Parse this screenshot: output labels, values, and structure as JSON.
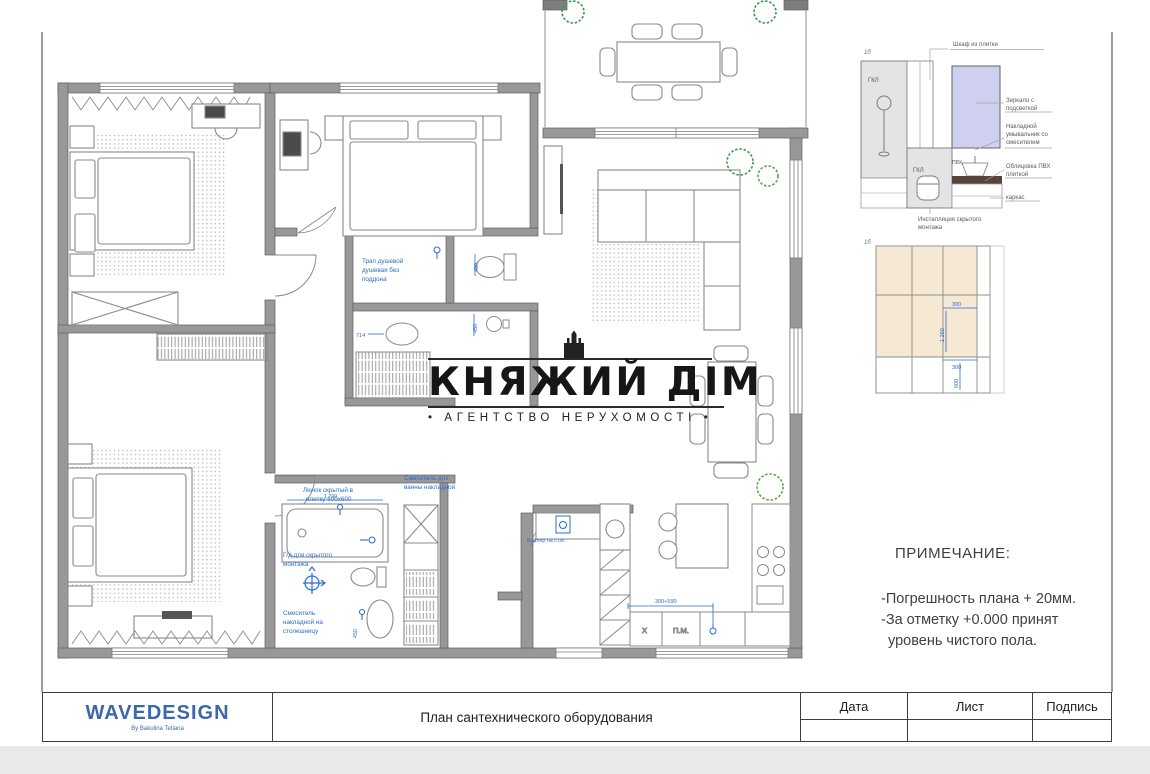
{
  "watermark": {
    "title": "КНЯЖИЙ ДІМ",
    "subtitle": "• АГЕНТСТВО НЕРУХОМОСТІ •"
  },
  "notes": {
    "heading": "ПРИМЕЧАНИЕ:",
    "lines": [
      "-Погрешность плана + 20мм.",
      "-За отметку +0.000 принят",
      "уровень чистого пола."
    ]
  },
  "title_block": {
    "brand": "WAVEDESIGN",
    "brand_subtitle": "By Bakulina Tetiana",
    "drawing_title": "План сантехнического оборудования",
    "columns": [
      "Дата",
      "Лист",
      "Подпись"
    ]
  },
  "plan": {
    "shower_note": [
      "Трап душевой",
      "душевая без",
      "поддона"
    ],
    "hatch_note": [
      "Лючок скрытый в",
      "плитку 600х600"
    ],
    "bath_mixer_note": [
      "Смеситель для",
      "ванны накладной"
    ],
    "concealed_note": [
      "Г/д для скрытого",
      "монтажа"
    ],
    "counter_mixer_note": [
      "Смеситель",
      "накладной на",
      "столешницу"
    ],
    "boiler_note": "Бойлер на ст.м.",
    "kitchen_dim": "300+590",
    "labels": {
      "fridge": "Х",
      "dishwasher": "П.М."
    },
    "dims": {
      "wc_toilet": "430",
      "wc_sink": "450",
      "bath_oval": "714",
      "tub_len": "1 700",
      "counter": "450"
    }
  },
  "details": {
    "elevation": {
      "ref": "1б",
      "top_label": "Шкаф из плитки",
      "board_left": "ГКЛ",
      "board_mid": "ГКЛ",
      "panel": "ПВХ",
      "label_mirror": [
        "Зеркало с",
        "подсветкой"
      ],
      "label_sink": [
        "Накладной",
        "умывальник со",
        "смесителем"
      ],
      "label_tile": [
        "Облицовка ПВХ",
        "плиткой"
      ],
      "label_frame": "каркас",
      "bottom_label": [
        "Инсталляция скрытого",
        "монтажа"
      ]
    },
    "tiles": {
      "ref": "1б",
      "dim_a": "300",
      "dim_b": "1 250",
      "dim_c": "300",
      "dim_d": "600"
    }
  },
  "colors": {
    "annotation_blue": "#2a6cd0",
    "brand_blue": "#3a68a8",
    "tile_beige": "#f6e9d4",
    "mirror_lavender": "#cfd0f0",
    "plant_green": "#2e9e46",
    "wall_gray": "#98989a"
  }
}
